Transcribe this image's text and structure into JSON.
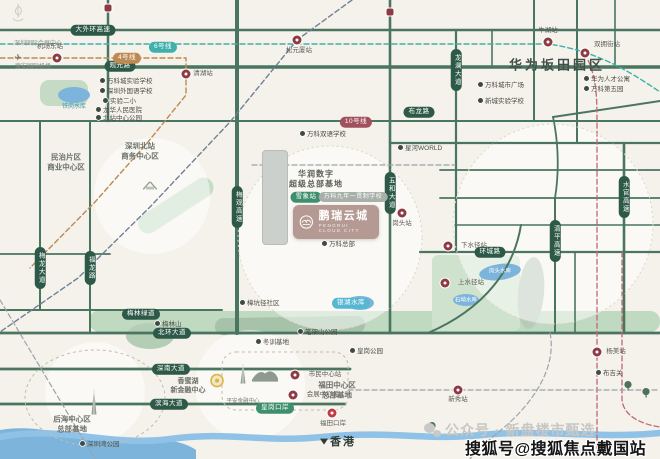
{
  "canvas": {
    "w": 660,
    "h": 459,
    "bg": "#f4f2ea"
  },
  "palette": {
    "road": "#4a7560",
    "road_pill": "#2d5948",
    "park": "#c0d9c1",
    "water": "#7cb4dc",
    "metro_tan": "#bd8a52",
    "metro_teal": "#3fb0ab",
    "metro_navy": "#6f8096",
    "metro_pink": "#c26678",
    "station": "#8e3a44",
    "station_red": "#c03b47",
    "badge": "#b49a93"
  },
  "project": {
    "name": "鹏瑞云城",
    "sub": "PENGRUI CLOUD CITY"
  },
  "watermarks": {
    "gray": "公众号 · 新盘楼市甄选",
    "black": "搜狐号@搜狐焦点戴国站"
  },
  "road_pills": [
    {
      "t": "大外环高速",
      "x": 93,
      "y": 30
    },
    {
      "t": "观光路",
      "x": 120,
      "y": 66
    },
    {
      "t": "布龙路",
      "x": 419,
      "y": 112
    },
    {
      "t": "环城路",
      "x": 490,
      "y": 252
    },
    {
      "t": "梅林绿道",
      "x": 141,
      "y": 314
    },
    {
      "t": "北环大道",
      "x": 172,
      "y": 333
    },
    {
      "t": "深南大道",
      "x": 171,
      "y": 369
    },
    {
      "t": "滨海大道",
      "x": 169,
      "y": 404
    },
    {
      "t": "梅观高速",
      "x": 237,
      "y": 207,
      "vert": true
    },
    {
      "t": "五和大道",
      "x": 390,
      "y": 193,
      "vert": true
    },
    {
      "t": "清平高速",
      "x": 555,
      "y": 241,
      "vert": true
    },
    {
      "t": "水官高速",
      "x": 624,
      "y": 197,
      "vert": true
    },
    {
      "t": "福龙路",
      "x": 90,
      "y": 268,
      "vert": true
    },
    {
      "t": "梅龙大道",
      "x": 40,
      "y": 268,
      "vert": true
    },
    {
      "t": "龙澜大道",
      "x": 456,
      "y": 70,
      "vert": true
    }
  ],
  "metro_pills": [
    {
      "t": "4号线",
      "x": 127,
      "y": 58,
      "bg": "#bd8a52"
    },
    {
      "t": "6号线",
      "x": 163,
      "y": 47,
      "bg": "#3fb0ab"
    },
    {
      "t": "10号线",
      "x": 356,
      "y": 122,
      "bg": "#a2505e"
    },
    {
      "t": "银湖水库",
      "x": 351,
      "y": 303,
      "bg": "#57b7d2"
    },
    {
      "t": "雪象站",
      "x": 306,
      "y": 197,
      "bg": "#3f8f6e"
    },
    {
      "t": "万科九年一贯制学校",
      "x": 353,
      "y": 197,
      "bg": "#a8aea8"
    },
    {
      "t": "皇岗口岸",
      "x": 275,
      "y": 408,
      "bg": "#3f8f6e"
    }
  ],
  "stations": [
    {
      "x": 57,
      "y": 58,
      "t": "机场东站",
      "lx": 50,
      "ly": 47
    },
    {
      "x": 186,
      "y": 74,
      "t": "清湖站",
      "lx": 203,
      "ly": 74
    },
    {
      "x": 297,
      "y": 40,
      "t": "松元厦站",
      "lx": 299,
      "ly": 51
    },
    {
      "x": 548,
      "y": 42,
      "t": "牛湖站",
      "lx": 548,
      "ly": 31
    },
    {
      "x": 585,
      "y": 53,
      "t": "双拥街站",
      "lx": 607,
      "ly": 45
    },
    {
      "x": 448,
      "y": 246,
      "t": "下水径站",
      "lx": 474,
      "ly": 246
    },
    {
      "x": 445,
      "y": 283,
      "t": "上水径站",
      "lx": 471,
      "ly": 283
    },
    {
      "x": 402,
      "y": 213,
      "t": "岗头站",
      "lx": 402,
      "ly": 224
    },
    {
      "x": 597,
      "y": 352,
      "t": "杨美站",
      "lx": 616,
      "ly": 352
    },
    {
      "x": 458,
      "y": 390,
      "t": "新秀站",
      "lx": 458,
      "ly": 400
    },
    {
      "x": 295,
      "y": 375,
      "t": "市民中心站",
      "lx": 325,
      "ly": 375
    },
    {
      "x": 293,
      "y": 395,
      "t": "会展中心站",
      "lx": 323,
      "ly": 395
    },
    {
      "x": 332,
      "y": 413,
      "t": "福田口岸",
      "lx": 333,
      "ly": 424,
      "red": true
    }
  ],
  "station_squares": [
    {
      "x": 108,
      "y": 8
    },
    {
      "x": 390,
      "y": 12
    }
  ],
  "pois": [
    {
      "t": "万科城实验学校",
      "x": 100,
      "y": 80
    },
    {
      "t": "深圳外国语学校",
      "x": 100,
      "y": 90
    },
    {
      "t": "实验二小",
      "x": 103,
      "y": 100
    },
    {
      "t": "龙华人民医院",
      "x": 96,
      "y": 109
    },
    {
      "t": "北站中心公园",
      "x": 96,
      "y": 117
    },
    {
      "t": "万科双语学校",
      "x": 300,
      "y": 133
    },
    {
      "t": "星河WORLD",
      "x": 398,
      "y": 147
    },
    {
      "t": "万科城市广场",
      "x": 478,
      "y": 84
    },
    {
      "t": "新城实验学校",
      "x": 478,
      "y": 100
    },
    {
      "t": "华为人才公寓",
      "x": 584,
      "y": 78
    },
    {
      "t": "万科第五园",
      "x": 584,
      "y": 88
    },
    {
      "t": "万科总部",
      "x": 322,
      "y": 243
    },
    {
      "t": "梅林山",
      "x": 155,
      "y": 323
    },
    {
      "t": "笔架山公园",
      "x": 298,
      "y": 331
    },
    {
      "t": "冬训基地",
      "x": 256,
      "y": 341
    },
    {
      "t": "樟坑径社区",
      "x": 240,
      "y": 302
    },
    {
      "t": "皇岗公园",
      "x": 350,
      "y": 350
    },
    {
      "t": "深圳湾公园",
      "x": 80,
      "y": 443
    },
    {
      "t": "布吉关",
      "x": 596,
      "y": 372
    }
  ],
  "areas": [
    {
      "lines": [
        "华为坂田园区"
      ],
      "x": 557,
      "y": 66,
      "fs": 13,
      "c": "#42504a",
      "ls": 3,
      "w": 700
    },
    {
      "lines": [
        "华润数字",
        "超级总部基地"
      ],
      "x": 316,
      "y": 180,
      "fs": 8,
      "c": "#5c6059",
      "ls": 1,
      "w": 700
    },
    {
      "lines": [
        "深圳北站",
        "商务中心区"
      ],
      "x": 140,
      "y": 151,
      "fs": 7.5,
      "c": "#6d726b",
      "w": 600
    },
    {
      "lines": [
        "民治片区",
        "商业中心区"
      ],
      "x": 66,
      "y": 162,
      "fs": 7.5,
      "c": "#6d726b",
      "w": 600
    },
    {
      "lines": [
        "香蜜湖",
        "新金融中心"
      ],
      "x": 188,
      "y": 386,
      "fs": 7,
      "c": "#6d726b",
      "w": 600
    },
    {
      "lines": [
        "福田中心区",
        "总部基地"
      ],
      "x": 337,
      "y": 390,
      "fs": 7.5,
      "c": "#6d726b",
      "w": 600
    },
    {
      "lines": [
        "后海中心区",
        "总部基地"
      ],
      "x": 72,
      "y": 424,
      "fs": 7.5,
      "c": "#6d726b",
      "w": 600
    },
    {
      "lines": [
        "深圳国际会展中心"
      ],
      "x": 38,
      "y": 45,
      "fs": 6,
      "c": "#8d8d86"
    },
    {
      "lines": [
        "宝安国际机场"
      ],
      "x": 33,
      "y": 68,
      "fs": 6,
      "c": "#8d8d86"
    },
    {
      "lines": [
        "平安金融中心"
      ],
      "x": 243,
      "y": 402,
      "fs": 5.5,
      "c": "#77776f"
    },
    {
      "lines": [
        "香港"
      ],
      "x": 343,
      "y": 442,
      "fs": 11,
      "c": "#2f3b37",
      "w": 700,
      "ls": 2
    },
    {
      "lines": [
        "坂雪岗大道"
      ],
      "x": 273,
      "y": 197,
      "fs": 6,
      "c": "#6b8fb5",
      "vert": true
    },
    {
      "lines": [
        "铁岗水库"
      ],
      "x": 74,
      "y": 108,
      "fs": 6,
      "c": "#3b98b5"
    },
    {
      "lines": [
        "岗头水库"
      ],
      "x": 500,
      "y": 272,
      "fs": 5.5,
      "c": "#ffffff"
    },
    {
      "lines": [
        "石坳水库"
      ],
      "x": 466,
      "y": 301,
      "fs": 5.5,
      "c": "#ffffff"
    }
  ],
  "landmarks": [
    {
      "type": "tower",
      "x": 94,
      "y": 405,
      "h": 26
    },
    {
      "type": "tower",
      "x": 243,
      "y": 377,
      "h": 20
    },
    {
      "type": "roof",
      "x": 265,
      "y": 380
    },
    {
      "type": "gold",
      "x": 217,
      "y": 384
    },
    {
      "type": "plane",
      "x": 18,
      "y": 57
    },
    {
      "type": "trainstation",
      "x": 150,
      "y": 186
    },
    {
      "type": "tree",
      "x": 432,
      "y": 428
    },
    {
      "type": "tree",
      "x": 628,
      "y": 387
    },
    {
      "type": "tree",
      "x": 646,
      "y": 394
    },
    {
      "type": "ferry",
      "x": 324,
      "y": 441
    },
    {
      "type": "sail",
      "x": 18,
      "y": 16
    }
  ]
}
